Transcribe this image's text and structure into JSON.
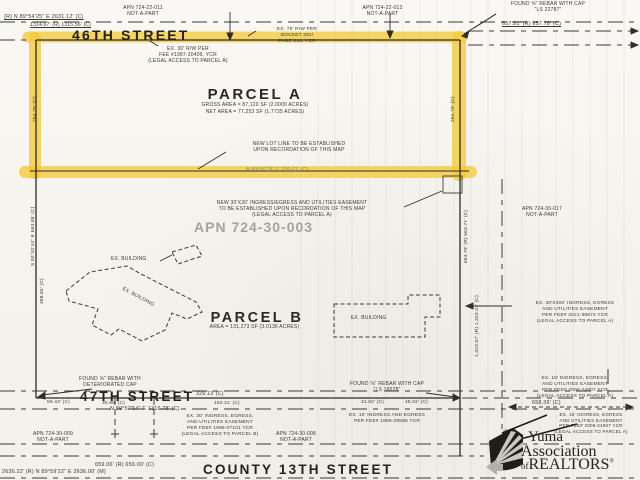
{
  "streets": {
    "s46": "46TH STREET",
    "s47": "47TH STREET",
    "c13": "COUNTY 13TH STREET"
  },
  "parcel_a": {
    "name": "PARCEL A",
    "gross_area": "GROSS AREA = 87,120 SF (2.0000 ACRES)",
    "net_area": "NET AREA = 77,253 SF (1.7735 ACRES)"
  },
  "parcel_b": {
    "name": "PARCEL B",
    "area": "AREA = 131,273 SF (3.0136 ACRES)"
  },
  "apn": {
    "main": "APN 724-30-003",
    "nw": "APN 724-22-011\nNOT-A-PART",
    "ne": "APN 724-22-012\nNOT-A-PART",
    "east": "APN 724-30-017\nNOT-A-PART",
    "sw": "APN 724-30-009\nNOT-A-PART",
    "south": "APN 724-30-008\nNOT-A-PART"
  },
  "monuments": {
    "ne": "FOUND ⅝\" REBAR WITH CAP\n\"LS 22787\"",
    "sw": "FOUND ⅝\" REBAR WITH\nDETERIORATED CAP",
    "se": "FOUND ⅝\" REBAR WITH CAP\n\"LS 16528\""
  },
  "notes": {
    "rw75": "EX. 75' R/W PER\nDOCKET 281/\nPAGE 244, YCR",
    "rw30": "EX. 30' R/W PER\nFEE #1997-30409, YCR\n(LEGAL ACCESS TO PARCEL A)",
    "new_lot_line": "NEW LOT LINE TO BE ESTABLISHED\nUPON RECORDATION OF THIS MAP",
    "new_easement": "NEW 30'X30' INGRESS/EGRESS AND UTILITIES EASEMENT\nTO BE ESTABLISHED UPON RECORDATION OF THIS MAP\n(LEGAL ACCESS TO PARCEL A)",
    "e30x400": "EX. 30'X400' INGRESS, EGRESS\nAND UTILITIES EASEMENT\nPER FEE# 2021-39674 YCR\n(LEGAL ACCESS TO PARCEL A)",
    "e30_b": "EX. 30' INGRESS, EGRESS,\nAND UTILITIES EASEMENT\nPER FEE# 1998-07101 YCR\n(LEGAL ACCESS TO PARCEL B)",
    "e10": "EX. 10' INGRESS AND EGRESS\nPER FEE# 1999-29588 YCR",
    "e15_a": "EX. 15' INGRESS, EGRESS,\nAND UTILITIES EASEMENT\nPER FEE# 2006-24907 YCR\n(LEGAL ACCESS TO PARCEL A)",
    "e15_b": "EX. 15' INGRESS, EGRESS\nAND UTILITIES EASEMENT\nPER FEE# 2006-24907 YCR\n(LEGAL ACCESS TO PARCEL A)",
    "building": "EX. BUILDING"
  },
  "dimensions": {
    "top_left_bearing": "(R) N 89°54'25\" E 2631.12' (C)",
    "top_left_dist": "1314.67' (R) 1315.56' (C)",
    "top_right": "657.81' (R) 657.78' (C)",
    "new_lot": "N 89°56'25\" E 329.01' (C)",
    "west_a": "264.79' (C)",
    "east_a": "264.79' (C)",
    "west_bearing": "S 00°02'44\" E 663.88' (C)",
    "west_dist": "398.84' (C)",
    "east_dim1": "663.79' (R) 663.71' (C)",
    "east_dim2": "1,323.57' (R) 1,323.47' (C)",
    "s47_1": "329.13' (C)",
    "s47_2": "59.43' (C)",
    "s47_3": "30.96' (C)",
    "s47_4": "163.21' (C)",
    "s47_bearing": "N 89°57'54\" E 1316.78' (C)",
    "s47_5": "31.92' (C)",
    "s47_6": "45.02' (C)",
    "se_dim": "658.39' (C)",
    "se_vert": "45.47' (C)",
    "c13_1": "659.06' (R) 659.00' (C)",
    "c13_2": "2636.22' (R) N 89°59'22\" E 2636.00' (M)"
  },
  "logo": {
    "line1": "Yuma",
    "line2": "Association",
    "of": "of",
    "name": "REALTORS",
    "reg": "®"
  },
  "colors": {
    "highlight": "#F2CA3D",
    "ink": "#35342F",
    "apn_gray": "#A8A399",
    "paper": "#F6F4EE"
  }
}
